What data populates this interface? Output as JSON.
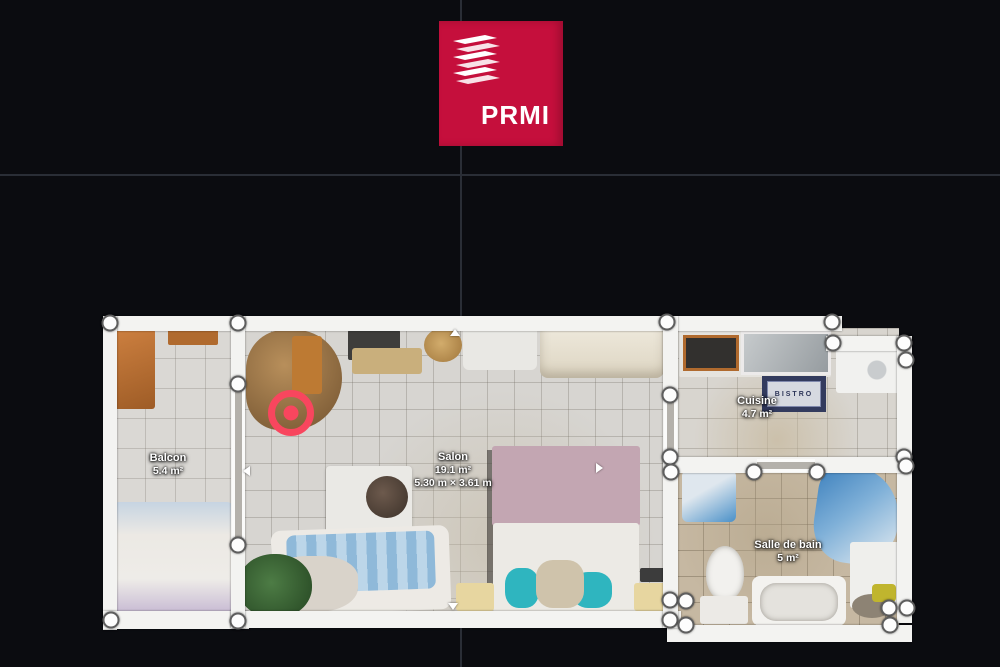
{
  "colors": {
    "brand": "#c50f3c",
    "marker": "#f8465e",
    "background": "#0b0c10",
    "grid": "#2a2e36",
    "wall": "#f3f3f1"
  },
  "logo": {
    "text": "PRMI"
  },
  "floorplan": {
    "rooms": {
      "balcon": {
        "name": "Balcon",
        "area": "5.4 m²"
      },
      "salon": {
        "name": "Salon",
        "area": "19.1 m²",
        "dimensions": "5.30 m × 3.61 m"
      },
      "cuisine": {
        "name": "Cuisine",
        "area": "4.7 m²"
      },
      "salle_de_bain": {
        "name": "Salle de bain",
        "area": "5 m²"
      }
    },
    "kitchen_mat_text": "BISTRO",
    "position_marker": {
      "x": 291,
      "y": 413
    },
    "vertex_handles": [
      [
        110,
        323
      ],
      [
        238,
        323
      ],
      [
        667,
        322
      ],
      [
        832,
        322
      ],
      [
        833,
        343
      ],
      [
        904,
        343
      ],
      [
        906,
        360
      ],
      [
        238,
        384
      ],
      [
        238,
        545
      ],
      [
        670,
        395
      ],
      [
        670,
        457
      ],
      [
        671,
        472
      ],
      [
        754,
        472
      ],
      [
        817,
        472
      ],
      [
        904,
        457
      ],
      [
        906,
        466
      ],
      [
        111,
        620
      ],
      [
        238,
        621
      ],
      [
        670,
        600
      ],
      [
        686,
        601
      ],
      [
        670,
        620
      ],
      [
        686,
        625
      ],
      [
        889,
        608
      ],
      [
        907,
        608
      ],
      [
        890,
        625
      ]
    ]
  }
}
